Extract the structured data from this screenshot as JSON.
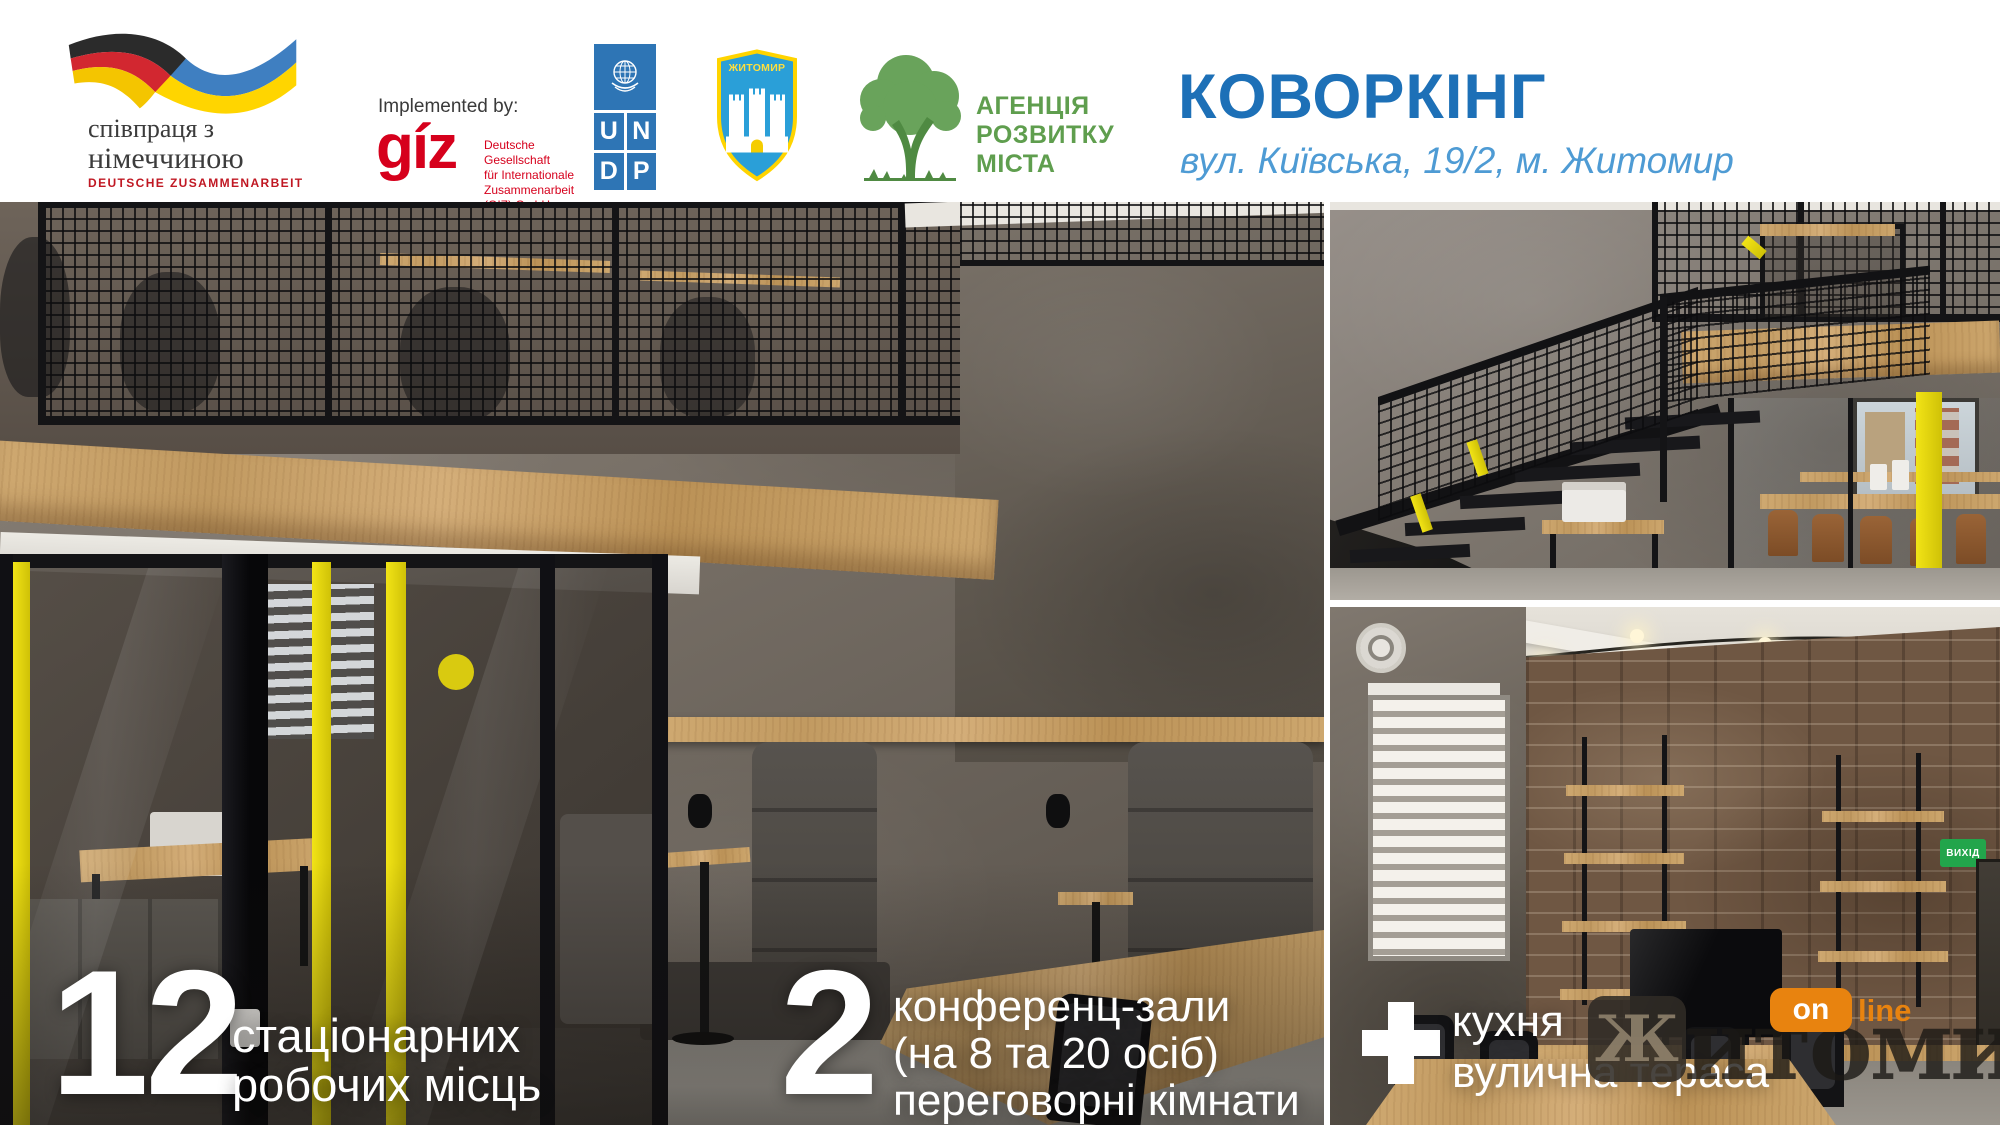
{
  "header": {
    "german_cooperation": {
      "line1": "співпраця з",
      "line2": "німеччиною",
      "subtitle": "DEUTSCHE ZUSAMMENARBEIT"
    },
    "implemented_by": "Implemented by:",
    "giz": {
      "wordmark": "gíz",
      "desc1": "Deutsche Gesellschaft",
      "desc2": "für Internationale",
      "desc3": "Zusammenarbeit (GIZ) GmbH"
    },
    "undp": {
      "u": "U",
      "n": "N",
      "d": "D",
      "p": "P"
    },
    "zhytomyr_arms": {
      "title": "ЖИТОМИР"
    },
    "agency": {
      "line1": "АГЕНЦІЯ",
      "line2": "РОЗВИТКУ",
      "line3": "МІСТА"
    },
    "title": "КОВОРКІНГ",
    "address": "вул. Київська, 19/2, м. Житомир"
  },
  "overlays": {
    "workplaces": {
      "number": "12",
      "line1": "стаціонарних",
      "line2": "робочих місць"
    },
    "conference": {
      "number": "2",
      "line1": "конференц-зали",
      "line2": "(на 8 та 20 осіб)",
      "line3": "переговорні кімнати"
    },
    "amenities": {
      "plus": "+",
      "line1": "кухня",
      "line2": "вулична тераса"
    }
  },
  "photo_labels": {
    "exit_sign": "ВИХІД"
  },
  "watermark": {
    "tile_letter": "Ж",
    "word_rest": "итомир",
    "badge_on": "on",
    "badge_line": "line"
  },
  "colors": {
    "title_blue": "#1d70b7",
    "address_blue": "#4e9bd4",
    "giz_red": "#d6001c",
    "coop_red": "#c01823",
    "agency_green": "#5f9e4e",
    "undp_blue": "#2e75b5",
    "arms_blue": "#2a9fd8",
    "arms_yellow": "#ffd400",
    "accent_yellow": "#e9da16",
    "watermark_orange": "#e8830f",
    "exit_green": "#22a54b"
  }
}
